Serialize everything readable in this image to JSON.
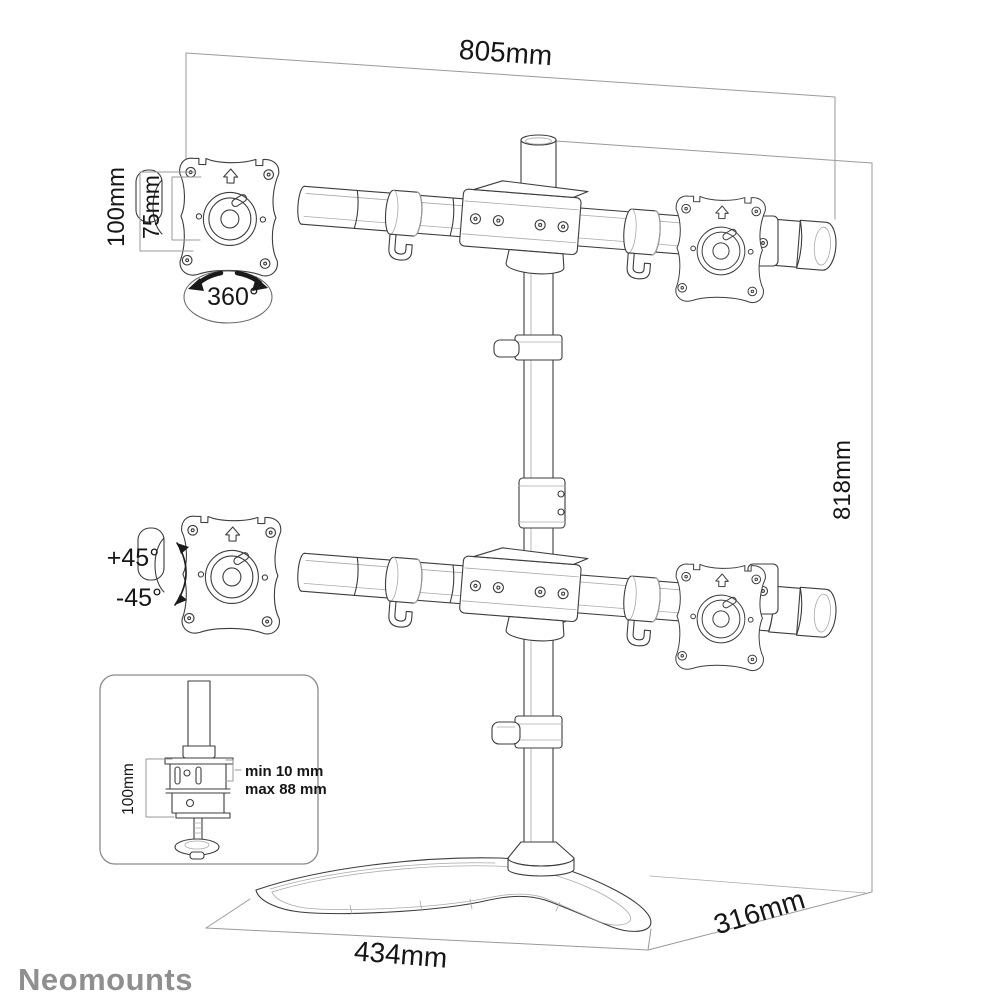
{
  "drawing": {
    "brand": "Neomounts",
    "dimensions": {
      "top_width": "805mm",
      "height": "818mm",
      "base_width": "434mm",
      "base_depth": "316mm",
      "vesa_outer": "100mm",
      "vesa_inner": "75mm"
    },
    "rotation": {
      "swivel": "360°",
      "tilt_up": "+45°",
      "tilt_down": "-45°"
    },
    "clamp_inset": {
      "height": "100mm",
      "min": "min 10 mm",
      "max": "max 88 mm"
    },
    "colors": {
      "product_line": "#3d3d3d",
      "dimension_line": "#9a9a9a",
      "text": "#161616",
      "brand": "#8f8f8f",
      "background": "#ffffff"
    }
  }
}
